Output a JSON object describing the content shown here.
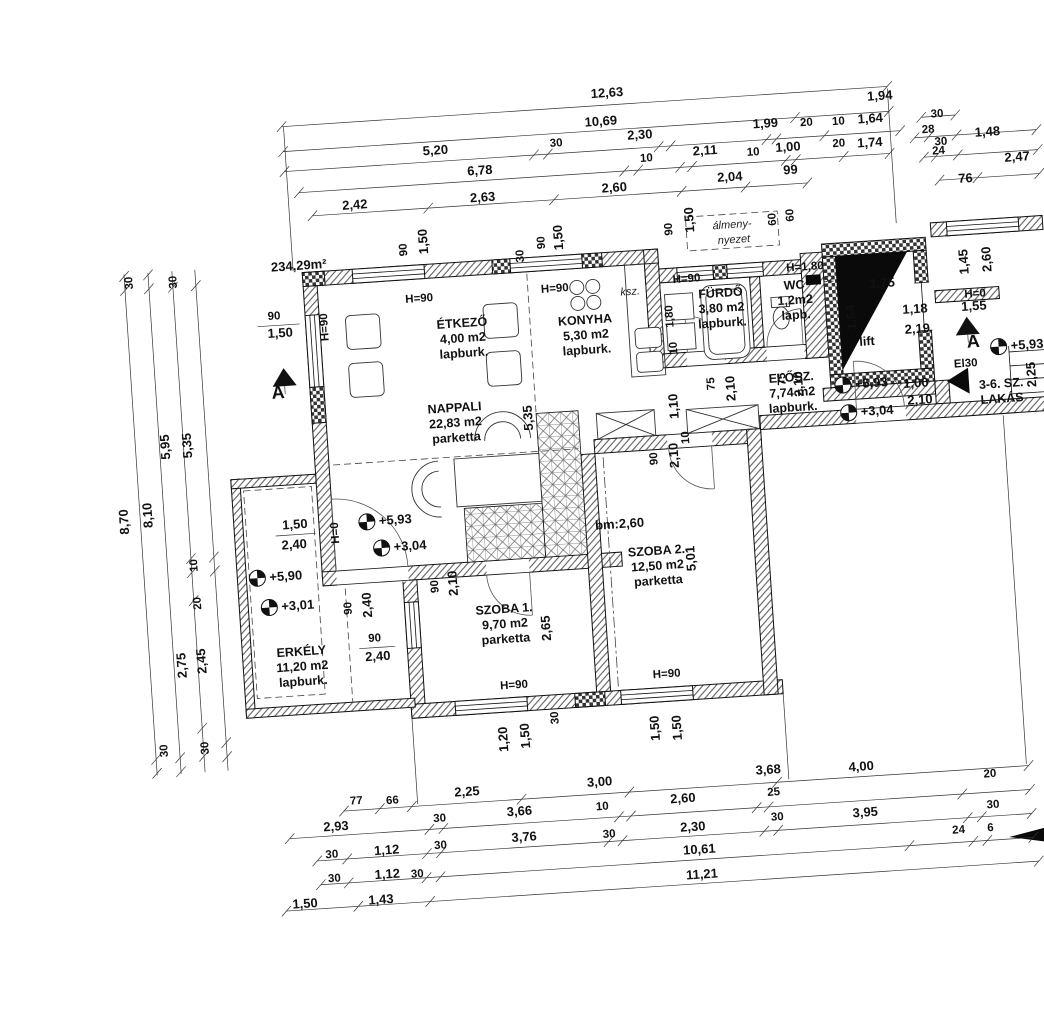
{
  "drawing": {
    "area_label": "234,29m²",
    "almennyezet_line1": "álmeny-",
    "almennyezet_line2": "nyezet",
    "ksz_label": "ksz.",
    "sz_label": "sz",
    "el30_label": "El30",
    "bm_label": "bm:2,60",
    "rooms": [
      {
        "x": 472,
        "y": 317,
        "lines": [
          "ÉTKEZŐ",
          "4,00 m2",
          "lapburk."
        ]
      },
      {
        "x": 595,
        "y": 322,
        "lines": [
          "KONYHA",
          "5,30 m2",
          "lapburk."
        ]
      },
      {
        "x": 459,
        "y": 401,
        "lines": [
          "NAPPALI",
          "22,83 m2",
          "parketta"
        ]
      },
      {
        "x": 732,
        "y": 304,
        "lines": [
          "FÜRDŐ",
          "3,80 m2",
          "lapburk."
        ]
      },
      {
        "x": 806,
        "y": 301,
        "lines": [
          "WC",
          "1,2m2",
          "lapb."
        ]
      },
      {
        "x": 797,
        "y": 393,
        "lines": [
          "ELŐSZ.",
          "7,74 m2",
          "lapburk."
        ]
      },
      {
        "x": 495,
        "y": 605,
        "lines": [
          "SZOBA 1.",
          "9,70 m2",
          "parketta"
        ]
      },
      {
        "x": 651,
        "y": 557,
        "lines": [
          "SZOBA 2.",
          "12,50 m2",
          "parketta"
        ]
      },
      {
        "x": 290,
        "y": 634,
        "lines": [
          "ERKÉLY",
          "11,20 m2",
          "lapburk."
        ]
      },
      {
        "x": 875,
        "y": 362,
        "lines": [
          "lift"
        ]
      },
      {
        "x": 1006,
        "y": 413,
        "lines": [
          "3-6. SZ.",
          "LAKÁS"
        ]
      }
    ],
    "levels": [
      {
        "t": "+5,93",
        "x": 364,
        "y": 505
      },
      {
        "t": "+3,04",
        "x": 377,
        "y": 532
      },
      {
        "t": "+5,90",
        "x": 251,
        "y": 554
      },
      {
        "t": "+3,01",
        "x": 261,
        "y": 584
      },
      {
        "t": "+5,93",
        "x": 848,
        "y": 400
      },
      {
        "t": "+3,04",
        "x": 852,
        "y": 428
      },
      {
        "t": "+5,93",
        "x": 1006,
        "y": 372
      }
    ],
    "sections": [
      {
        "t": "A",
        "tx": 291,
        "ty": 356,
        "lx": 284,
        "ly": 376
      },
      {
        "t": "A",
        "tx": 976,
        "ty": 350,
        "lx": 981,
        "ly": 371
      }
    ],
    "dim_labels": [
      {
        "t": "12,63",
        "x": 632,
        "y": 97
      },
      {
        "t": "1,94",
        "x": 904,
        "y": 118
      },
      {
        "t": "10,69",
        "x": 624,
        "y": 125
      },
      {
        "t": "5,20",
        "x": 457,
        "y": 143
      },
      {
        "t": "30",
        "x": 578,
        "y": 143,
        "s": 1
      },
      {
        "t": "2,30",
        "x": 662,
        "y": 141
      },
      {
        "t": "1,99",
        "x": 788,
        "y": 138
      },
      {
        "t": "20",
        "x": 829,
        "y": 139,
        "s": 1
      },
      {
        "t": "10",
        "x": 861,
        "y": 140,
        "s": 1
      },
      {
        "t": "1,64",
        "x": 893,
        "y": 140
      },
      {
        "t": "6,78",
        "x": 500,
        "y": 166
      },
      {
        "t": "10",
        "x": 667,
        "y": 164,
        "s": 1
      },
      {
        "t": "2,11",
        "x": 726,
        "y": 161
      },
      {
        "t": "10",
        "x": 774,
        "y": 165,
        "s": 1
      },
      {
        "t": "1,00",
        "x": 809,
        "y": 163
      },
      {
        "t": "20",
        "x": 860,
        "y": 162,
        "s": 1
      },
      {
        "t": "1,74",
        "x": 891,
        "y": 164
      },
      {
        "t": "2,42",
        "x": 373,
        "y": 192
      },
      {
        "t": "2,63",
        "x": 501,
        "y": 193
      },
      {
        "t": "2,60",
        "x": 633,
        "y": 192
      },
      {
        "t": "2,04",
        "x": 749,
        "y": 189
      },
      {
        "t": "99",
        "x": 810,
        "y": 186
      },
      {
        "t": "30",
        "x": 960,
        "y": 139,
        "s": 1
      },
      {
        "t": "28",
        "x": 950,
        "y": 154,
        "s": 1
      },
      {
        "t": "30",
        "x": 962,
        "y": 167,
        "s": 1
      },
      {
        "t": "1,48",
        "x": 1009,
        "y": 161
      },
      {
        "t": "24",
        "x": 959,
        "y": 176,
        "s": 1
      },
      {
        "t": "2,47",
        "x": 1037,
        "y": 188
      },
      {
        "t": "76",
        "x": 984,
        "y": 206
      },
      {
        "t": "30",
        "x": 146,
        "y": 251,
        "r": 1,
        "s": 1
      },
      {
        "t": "30",
        "x": 190,
        "y": 253,
        "r": 1,
        "s": 1
      },
      {
        "t": "5,95",
        "x": 172,
        "y": 417,
        "r": 1
      },
      {
        "t": "5,35",
        "x": 194,
        "y": 417,
        "r": 1
      },
      {
        "t": "8,70",
        "x": 126,
        "y": 489,
        "r": 1
      },
      {
        "t": "8,10",
        "x": 150,
        "y": 484,
        "r": 1
      },
      {
        "t": "10",
        "x": 192,
        "y": 537,
        "r": 1,
        "s": 1
      },
      {
        "t": "20",
        "x": 193,
        "y": 575,
        "r": 1,
        "s": 1
      },
      {
        "t": "2,75",
        "x": 174,
        "y": 636,
        "r": 1
      },
      {
        "t": "2,45",
        "x": 194,
        "y": 633,
        "r": 1
      },
      {
        "t": "30",
        "x": 150,
        "y": 720,
        "r": 1,
        "s": 1
      },
      {
        "t": "30",
        "x": 191,
        "y": 720,
        "r": 1,
        "s": 1
      },
      {
        "t": "77",
        "x": 335,
        "y": 786,
        "s": 1
      },
      {
        "t": "66",
        "x": 371,
        "y": 788,
        "s": 1
      },
      {
        "t": "2,25",
        "x": 446,
        "y": 785
      },
      {
        "t": "3,00",
        "x": 579,
        "y": 784
      },
      {
        "t": "3,68",
        "x": 748,
        "y": 783
      },
      {
        "t": "4,00",
        "x": 841,
        "y": 786
      },
      {
        "t": "2,93",
        "x": 313,
        "y": 811
      },
      {
        "t": "30",
        "x": 417,
        "y": 809,
        "s": 1
      },
      {
        "t": "3,66",
        "x": 497,
        "y": 808
      },
      {
        "t": "10",
        "x": 580,
        "y": 808,
        "s": 1
      },
      {
        "t": "2,60",
        "x": 661,
        "y": 806
      },
      {
        "t": "25",
        "x": 752,
        "y": 805,
        "s": 1
      },
      {
        "t": "20",
        "x": 969,
        "y": 801,
        "s": 1
      },
      {
        "t": "30",
        "x": 307,
        "y": 838,
        "s": 1
      },
      {
        "t": "1,12",
        "x": 362,
        "y": 838
      },
      {
        "t": "30",
        "x": 416,
        "y": 836,
        "s": 1
      },
      {
        "t": "3,76",
        "x": 500,
        "y": 834
      },
      {
        "t": "30",
        "x": 585,
        "y": 836,
        "s": 1
      },
      {
        "t": "2,30",
        "x": 669,
        "y": 835
      },
      {
        "t": "30",
        "x": 754,
        "y": 830,
        "s": 1
      },
      {
        "t": "3,95",
        "x": 842,
        "y": 832
      },
      {
        "t": "30",
        "x": 970,
        "y": 832,
        "s": 1
      },
      {
        "t": "30",
        "x": 308,
        "y": 862,
        "s": 1
      },
      {
        "t": "1,12",
        "x": 361,
        "y": 862
      },
      {
        "t": "30",
        "x": 391,
        "y": 863,
        "s": 1
      },
      {
        "t": "10,61",
        "x": 674,
        "y": 858
      },
      {
        "t": "24",
        "x": 934,
        "y": 855,
        "s": 1
      },
      {
        "t": "6",
        "x": 966,
        "y": 855,
        "s": 1
      },
      {
        "t": "1,50",
        "x": 277,
        "y": 886
      },
      {
        "t": "1,43",
        "x": 353,
        "y": 887
      },
      {
        "t": "11,21",
        "x": 675,
        "y": 883
      },
      {
        "t": "90",
        "x": 422,
        "y": 236,
        "r": 1,
        "s": 1
      },
      {
        "t": "1,50",
        "x": 443,
        "y": 229,
        "r": 1
      },
      {
        "t": "30",
        "x": 538,
        "y": 250,
        "r": 1,
        "s": 1
      },
      {
        "t": "90",
        "x": 560,
        "y": 238,
        "r": 1,
        "s": 1
      },
      {
        "t": "1,50",
        "x": 578,
        "y": 234,
        "r": 1
      },
      {
        "t": "90",
        "x": 688,
        "y": 233,
        "r": 1,
        "s": 1
      },
      {
        "t": "1,50",
        "x": 710,
        "y": 225,
        "r": 1
      },
      {
        "t": "60",
        "x": 792,
        "y": 230,
        "r": 1,
        "s": 1
      },
      {
        "t": "60",
        "x": 810,
        "y": 227,
        "r": 1,
        "s": 1
      },
      {
        "t": "90",
        "x": 285,
        "y": 297,
        "s": 1
      },
      {
        "t": "1,50",
        "x": 290,
        "y": 315
      },
      {
        "t": "H=90",
        "x": 431,
        "y": 289,
        "s": 1
      },
      {
        "t": "H=90",
        "x": 567,
        "y": 288,
        "s": 1
      },
      {
        "t": "H=90",
        "x": 699,
        "y": 287,
        "s": 1
      },
      {
        "t": "H=90",
        "x": 338,
        "y": 308,
        "r": 1,
        "s": 1
      },
      {
        "t": "H=1,80",
        "x": 818,
        "y": 283,
        "s": 1
      },
      {
        "t": "5,35",
        "x": 536,
        "y": 412,
        "r": 1
      },
      {
        "t": "1,80",
        "x": 683,
        "y": 320,
        "r": 1,
        "s": 1
      },
      {
        "t": "10",
        "x": 685,
        "y": 352,
        "r": 1,
        "s": 1
      },
      {
        "t": "75",
        "x": 720,
        "y": 390,
        "r": 1,
        "s": 1
      },
      {
        "t": "2,10",
        "x": 740,
        "y": 396,
        "r": 1
      },
      {
        "t": "75",
        "x": 791,
        "y": 390,
        "r": 1,
        "s": 1
      },
      {
        "t": "2,10",
        "x": 808,
        "y": 396,
        "r": 1
      },
      {
        "t": "1,10",
        "x": 682,
        "y": 410,
        "r": 1
      },
      {
        "t": "1,75",
        "x": 894,
        "y": 305
      },
      {
        "t": "1,64",
        "x": 865,
        "y": 333,
        "r": 1
      },
      {
        "t": "1,18",
        "x": 925,
        "y": 333
      },
      {
        "t": "2,19",
        "x": 926,
        "y": 353
      },
      {
        "t": "1,00",
        "x": 921,
        "y": 407
      },
      {
        "t": "2,10",
        "x": 924,
        "y": 424
      },
      {
        "t": "1,45",
        "x": 981,
        "y": 285,
        "r": 1
      },
      {
        "t": "2,60",
        "x": 1004,
        "y": 284,
        "r": 1
      },
      {
        "t": "H=0",
        "x": 986,
        "y": 321,
        "s": 1
      },
      {
        "t": "1,55",
        "x": 984,
        "y": 334
      },
      {
        "t": "2,25",
        "x": 1041,
        "y": 402,
        "r": 1
      },
      {
        "t": "90",
        "x": 658,
        "y": 461,
        "r": 1,
        "s": 1
      },
      {
        "t": "2,10",
        "x": 679,
        "y": 459,
        "r": 1
      },
      {
        "t": "10",
        "x": 691,
        "y": 442,
        "r": 1,
        "s": 1
      },
      {
        "t": "5,01",
        "x": 689,
        "y": 563,
        "r": 1
      },
      {
        "t": "2,65",
        "x": 540,
        "y": 623,
        "r": 1
      },
      {
        "t": "1,50",
        "x": 292,
        "y": 507
      },
      {
        "t": "2,40",
        "x": 290,
        "y": 527
      },
      {
        "t": "H=0",
        "x": 335,
        "y": 514,
        "r": 1,
        "s": 1
      },
      {
        "t": "90",
        "x": 343,
        "y": 590,
        "r": 1,
        "s": 1
      },
      {
        "t": "2,40",
        "x": 363,
        "y": 588,
        "r": 1
      },
      {
        "t": "90",
        "x": 364,
        "y": 625,
        "s": 1
      },
      {
        "t": "2,40",
        "x": 366,
        "y": 644
      },
      {
        "t": "90",
        "x": 431,
        "y": 574,
        "r": 1,
        "s": 1
      },
      {
        "t": "2,10",
        "x": 450,
        "y": 572,
        "r": 1
      },
      {
        "t": "H=90",
        "x": 500,
        "y": 681,
        "s": 1
      },
      {
        "t": "H=90",
        "x": 653,
        "y": 680,
        "s": 1
      },
      {
        "t": "1,20",
        "x": 490,
        "y": 731,
        "r": 1
      },
      {
        "t": "1,50",
        "x": 512,
        "y": 729,
        "r": 1
      },
      {
        "t": "30",
        "x": 542,
        "y": 713,
        "r": 1,
        "s": 1
      },
      {
        "t": "1,50",
        "x": 642,
        "y": 730,
        "r": 1
      },
      {
        "t": "1,50",
        "x": 664,
        "y": 731,
        "r": 1
      }
    ],
    "chains": [
      {
        "o": "h",
        "y": 105,
        "x1": 305,
        "x2": 912,
        "t": [
          305,
          912
        ]
      },
      {
        "o": "h",
        "y": 130,
        "x1": 305,
        "x2": 912,
        "t": [
          305,
          818,
          912
        ]
      },
      {
        "o": "h",
        "y": 150,
        "x1": 305,
        "x2": 922,
        "t": [
          305,
          555,
          569,
          680,
          692,
          788,
          798,
          846,
          922
        ]
      },
      {
        "o": "h",
        "y": 172,
        "x1": 318,
        "x2": 910,
        "t": [
          318,
          644,
          658,
          700,
          712,
          806,
          816,
          864,
          910
        ]
      },
      {
        "o": "h",
        "y": 196,
        "x1": 330,
        "x2": 826,
        "t": [
          330,
          446,
          572,
          700,
          764,
          826
        ]
      },
      {
        "o": "h",
        "y": 138,
        "x1": 944,
        "x2": 978,
        "t": [
          944,
          978
        ]
      },
      {
        "o": "h",
        "y": 158,
        "x1": 936,
        "x2": 1058,
        "t": [
          936,
          950,
          978,
          1058
        ]
      },
      {
        "o": "h",
        "y": 178,
        "x1": 944,
        "x2": 1058,
        "t": [
          944,
          956,
          978,
          1058
        ]
      },
      {
        "o": "h",
        "y": 202,
        "x1": 958,
        "x2": 1058,
        "t": [
          958,
          996,
          1058
        ]
      },
      {
        "o": "v",
        "x": 138,
        "y1": 242,
        "y2": 744,
        "t": [
          244,
          258,
          728,
          742
        ]
      },
      {
        "o": "v",
        "x": 162,
        "y1": 242,
        "y2": 744,
        "t": [
          244,
          258,
          728,
          742
        ]
      },
      {
        "o": "v",
        "x": 186,
        "y1": 242,
        "y2": 744,
        "t": [
          258,
          530,
          544,
          572,
          700,
          728
        ]
      },
      {
        "o": "v",
        "x": 209,
        "y1": 242,
        "y2": 744,
        "t": [
          258,
          530,
          544,
          716,
          730
        ]
      },
      {
        "o": "h",
        "y": 792,
        "x1": 322,
        "x2": 1008,
        "t": [
          322,
          358,
          390,
          500,
          608,
          756,
          1008
        ]
      },
      {
        "o": "h",
        "y": 816,
        "x1": 266,
        "x2": 1008,
        "t": [
          266,
          406,
          420,
          596,
          608,
          734,
          746,
          940,
          1008
        ]
      },
      {
        "o": "h",
        "y": 840,
        "x1": 292,
        "x2": 1008,
        "t": [
          292,
          322,
          402,
          416,
          584,
          598,
          740,
          754,
          944,
          958,
          1008
        ]
      },
      {
        "o": "h",
        "y": 864,
        "x1": 294,
        "x2": 1008,
        "t": [
          294,
          322,
          400,
          414,
          884,
          948,
          962,
          1008
        ]
      },
      {
        "o": "h",
        "y": 888,
        "x1": 258,
        "x2": 1012,
        "t": [
          258,
          330,
          402,
          1012
        ]
      }
    ]
  }
}
